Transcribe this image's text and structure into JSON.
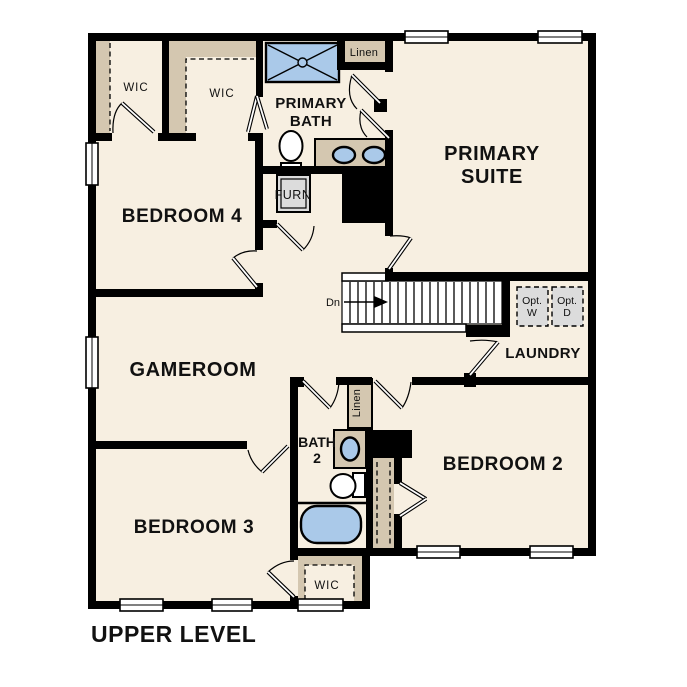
{
  "plan": {
    "title": "UPPER LEVEL",
    "rooms": {
      "primary_suite": {
        "lines": [
          "PRIMARY",
          "SUITE"
        ]
      },
      "primary_bath": {
        "lines": [
          "PRIMARY",
          "BATH"
        ]
      },
      "bedroom_4": {
        "label": "BEDROOM 4"
      },
      "gameroom": {
        "label": "GAMEROOM"
      },
      "bedroom_3": {
        "label": "BEDROOM 3"
      },
      "bedroom_2": {
        "label": "BEDROOM 2"
      },
      "bath_2": {
        "lines": [
          "BATH",
          "2"
        ]
      },
      "laundry": {
        "label": "LAUNDRY"
      },
      "wic_top_left": {
        "label": "WIC"
      },
      "wic_top_right": {
        "label": "WIC"
      },
      "wic_bedroom_3": {
        "label": "WIC"
      },
      "linen_upper": {
        "label": "Linen"
      },
      "linen_lower": {
        "label": "Linen"
      },
      "furnace": {
        "label": "FURN"
      }
    },
    "stairs": {
      "label": "Dn"
    },
    "appliances": {
      "washer": {
        "lines": [
          "Opt.",
          "W"
        ]
      },
      "dryer": {
        "lines": [
          "Opt.",
          "D"
        ]
      }
    },
    "colors": {
      "wall": "#000000",
      "floor": "#f7efe1",
      "closet": "#d4c7b0",
      "fixture_blue": "#aac9e9",
      "appliance_grey": "#dcdcdc",
      "text": "#111111"
    }
  }
}
